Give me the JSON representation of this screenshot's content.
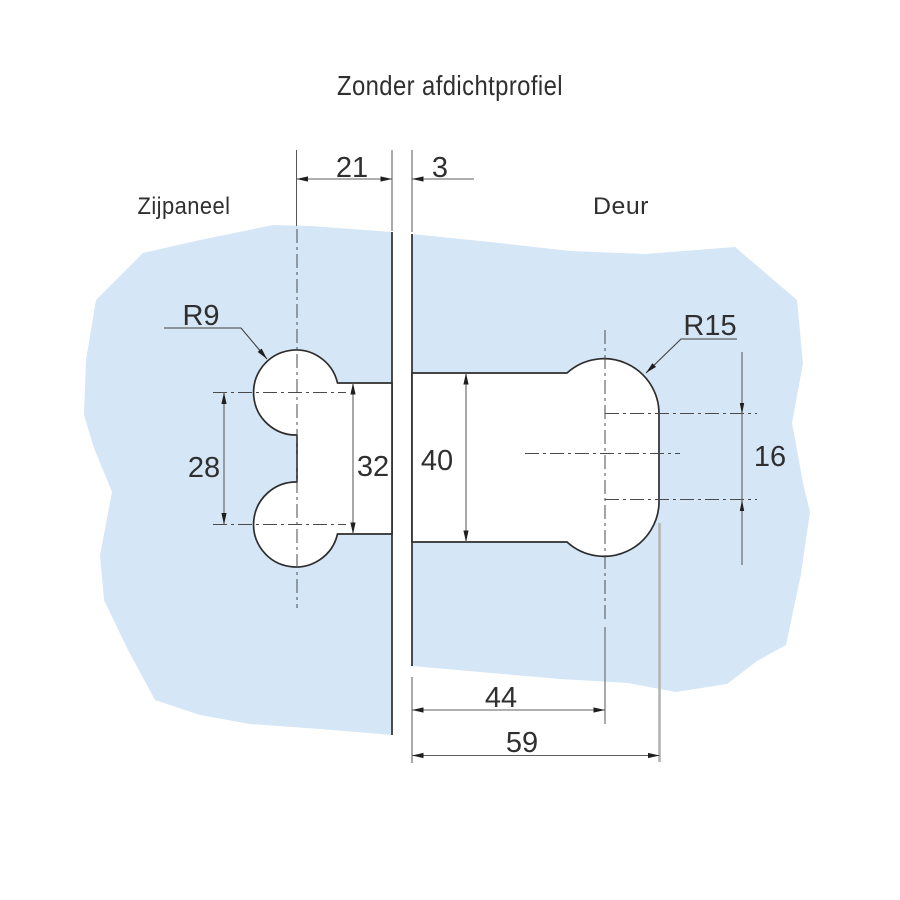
{
  "title": "Zonder afdichtprofiel",
  "labels": {
    "side_panel": "Zijpaneel",
    "door": "Deur"
  },
  "dimensions": {
    "panel_overlap": "21",
    "glass_gap": "3",
    "hole_spacing": "28",
    "panel_cutout_height": "32",
    "door_cutout_height": "40",
    "door_overlap_to_axis": "44",
    "total_depth": "59",
    "flat_edge_height": "16",
    "small_radius": "R9",
    "large_radius": "R15"
  },
  "colors": {
    "glass": "#d5e6f6",
    "outline": "#2d2d2d",
    "dimension_line": "#5f5f5f",
    "light_extension": "#b4b4b4",
    "text": "#2f2f2f"
  }
}
